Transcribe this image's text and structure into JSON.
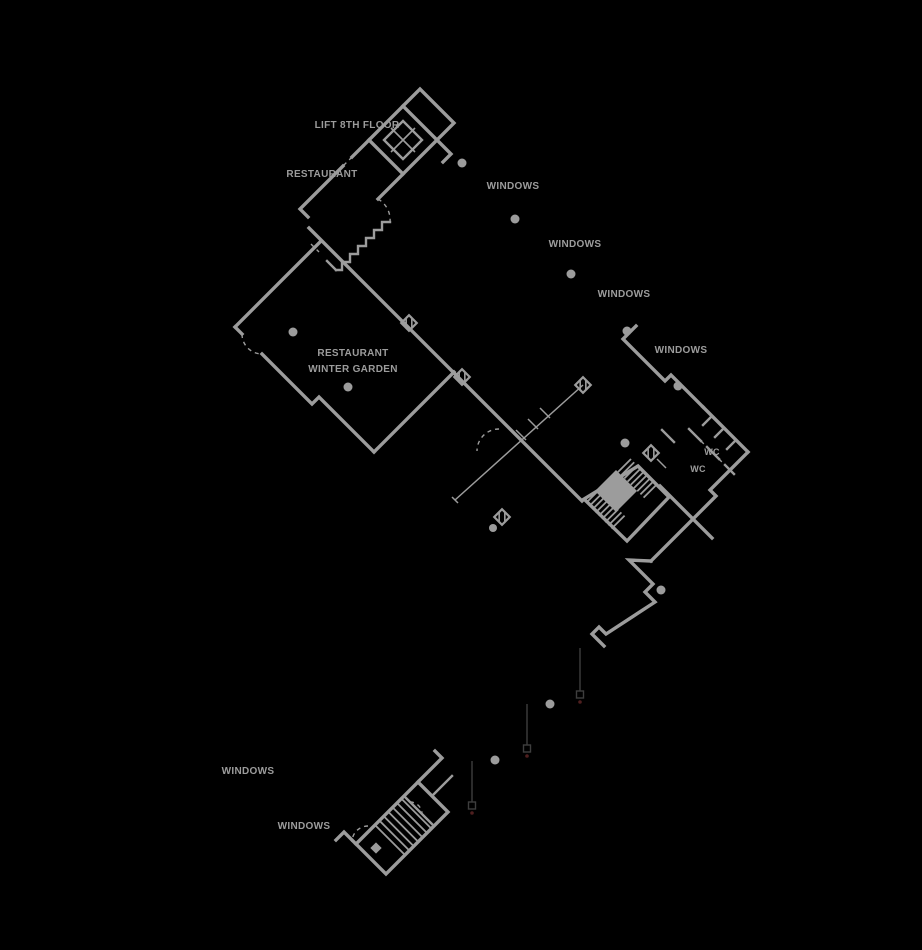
{
  "drawing": {
    "type": "architectural-floor-plan",
    "background": "#000000",
    "line_color": "#9c9c9c",
    "marker_color": "#3e3e3e",
    "accent_dot_color": "#4f1f1f",
    "canvas_width": 922,
    "canvas_height": 950
  },
  "labels": {
    "lift": "LIFT 8TH FLOOR",
    "restaurant": "RESTAURANT",
    "winter_garden_line1": "RESTAURANT",
    "winter_garden_line2": "WINTER GARDEN",
    "windows": "WINDOWS",
    "wc": "WC"
  },
  "annotations": [
    {
      "name": "lift-floor-label",
      "text": "LIFT 8TH FLOOR"
    },
    {
      "name": "restaurant-label",
      "text": "RESTAURANT"
    },
    {
      "name": "windows-label-1",
      "text": "WINDOWS"
    },
    {
      "name": "windows-label-2",
      "text": "WINDOWS"
    },
    {
      "name": "windows-label-3",
      "text": "WINDOWS"
    },
    {
      "name": "windows-label-4",
      "text": "WINDOWS"
    },
    {
      "name": "winter-garden-label-line1",
      "text": "RESTAURANT"
    },
    {
      "name": "winter-garden-label-line2",
      "text": "WINTER GARDEN"
    },
    {
      "name": "wc-label-1",
      "text": "WC"
    },
    {
      "name": "wc-label-2",
      "text": "WC"
    },
    {
      "name": "windows-label-5",
      "text": "WINDOWS"
    },
    {
      "name": "windows-label-6",
      "text": "WINDOWS"
    }
  ]
}
